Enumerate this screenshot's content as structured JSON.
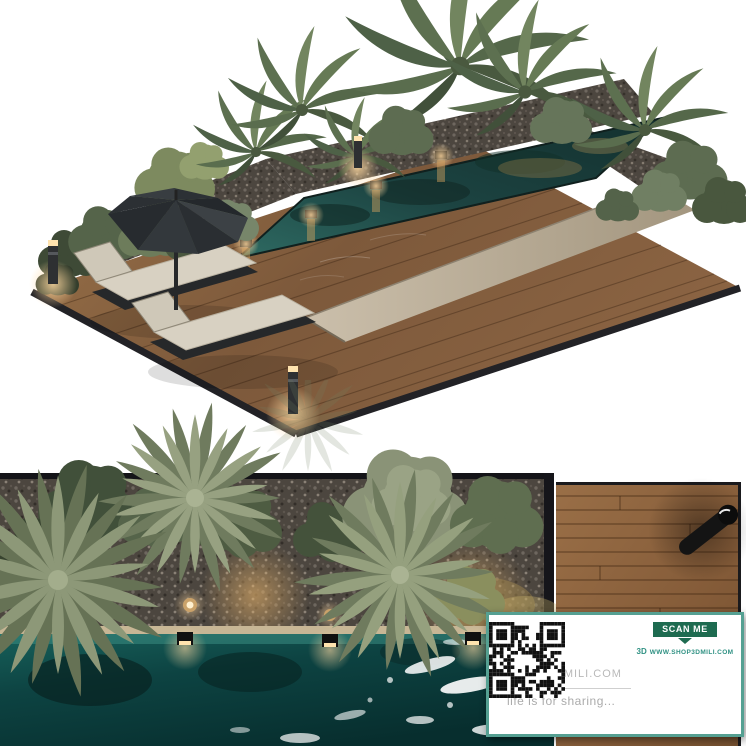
{
  "watermark": {
    "logo_text": "3D",
    "logo_suffix": "MILI.COM",
    "tagline": "life is for sharing...",
    "scan_me_label": "SCAN ME",
    "website_url": "WWW.SHOP3DMILI.COM",
    "footer_logo": "3D",
    "colors": {
      "card_border": "#55a092",
      "scan_banner": "#1e6b50",
      "logo_gray": "#c6c6c6",
      "tagline_gray": "#ababab",
      "url_teal": "#2f9183",
      "qr_black": "#111111"
    }
  },
  "scene_palette": {
    "background": "#ffffff",
    "deck_wood": "#8a6342",
    "deck_edge": "#222226",
    "pool_water_iso": "#1c4341",
    "pool_water_plan": "#0d4342",
    "foam_white": "#ffffff",
    "gravel": "#56504a",
    "foliage_sage": "#97a181",
    "foliage_dark": "#49593f",
    "concrete_walkway": "#b9ad9a",
    "umbrella_charcoal": "#33373b",
    "cushion_beige": "#d8d1c2",
    "light_glow": "#f0b56a"
  }
}
